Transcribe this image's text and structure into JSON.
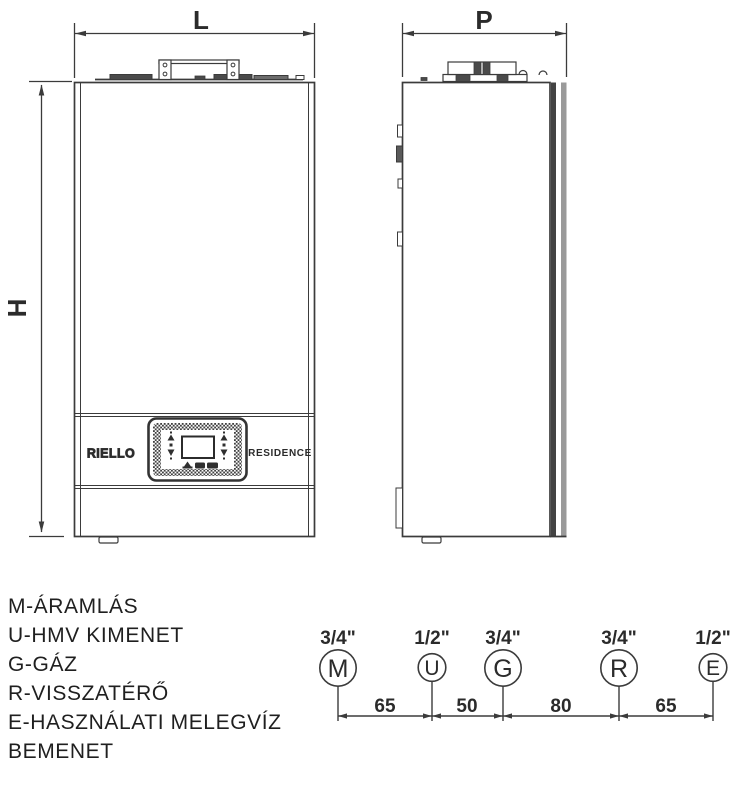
{
  "dimensions": {
    "width_label": "L",
    "height_label": "H",
    "depth_label": "P"
  },
  "front_view": {
    "brand": "RIELLO",
    "model": "RESIDENCE"
  },
  "legend": {
    "lines": [
      "M-ÁRAMLÁS",
      "U-HMV KIMENET",
      "G-GÁZ",
      "R-VISSZATÉRŐ",
      "E-HASZNÁLATI MELEGVÍZ",
      "BEMENET"
    ]
  },
  "connections": {
    "items": [
      {
        "letter": "M",
        "size": "3/4\""
      },
      {
        "letter": "U",
        "size": "1/2\""
      },
      {
        "letter": "G",
        "size": "3/4\""
      },
      {
        "letter": "R",
        "size": "3/4\""
      },
      {
        "letter": "E",
        "size": "1/2\""
      }
    ],
    "spacings": [
      "65",
      "50",
      "80",
      "65"
    ]
  },
  "colors": {
    "line": "#3b3b3b",
    "text": "#2b2b2b",
    "band_dark": "#434343",
    "band_gray": "#9a9a9a"
  }
}
